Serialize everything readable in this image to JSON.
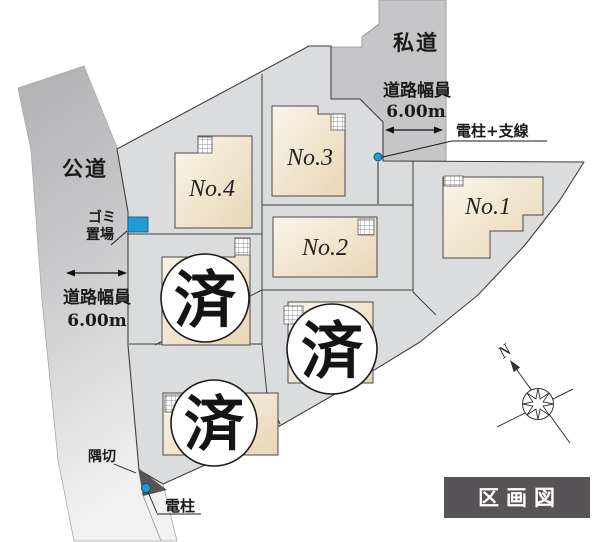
{
  "map": {
    "title": "区画図",
    "compass_north": "N"
  },
  "roads": {
    "public": "公道",
    "private": "私道"
  },
  "measurements": {
    "left": {
      "label": "道路幅員",
      "value": "6.00m"
    },
    "top": {
      "label": "道路幅員",
      "value": "6.00m"
    }
  },
  "markers": {
    "garbage": {
      "line1": "ゴミ",
      "line2": "置場"
    },
    "pole_with_wire": "電柱+支線",
    "pole": "電柱",
    "corner_cut": "隅切"
  },
  "plots": {
    "no1": "No.1",
    "no2": "No.2",
    "no3": "No.3",
    "no4": "No.4",
    "sold": "済"
  },
  "colors": {
    "site_fill": "#dbdcde",
    "road_fill": "#c6c6c8",
    "public_road_top": "#b0b0b2",
    "public_road_mid": "#c9c9cb",
    "public_road_bottom": "#f1f1f2",
    "house_fill_light": "#faf4e8",
    "house_fill_dark": "#e8d6b6",
    "outline": "#3f3f3f",
    "accent_blue": "#1e9cd8",
    "dark_gray": "#575356",
    "text": "#1a1a1a"
  }
}
